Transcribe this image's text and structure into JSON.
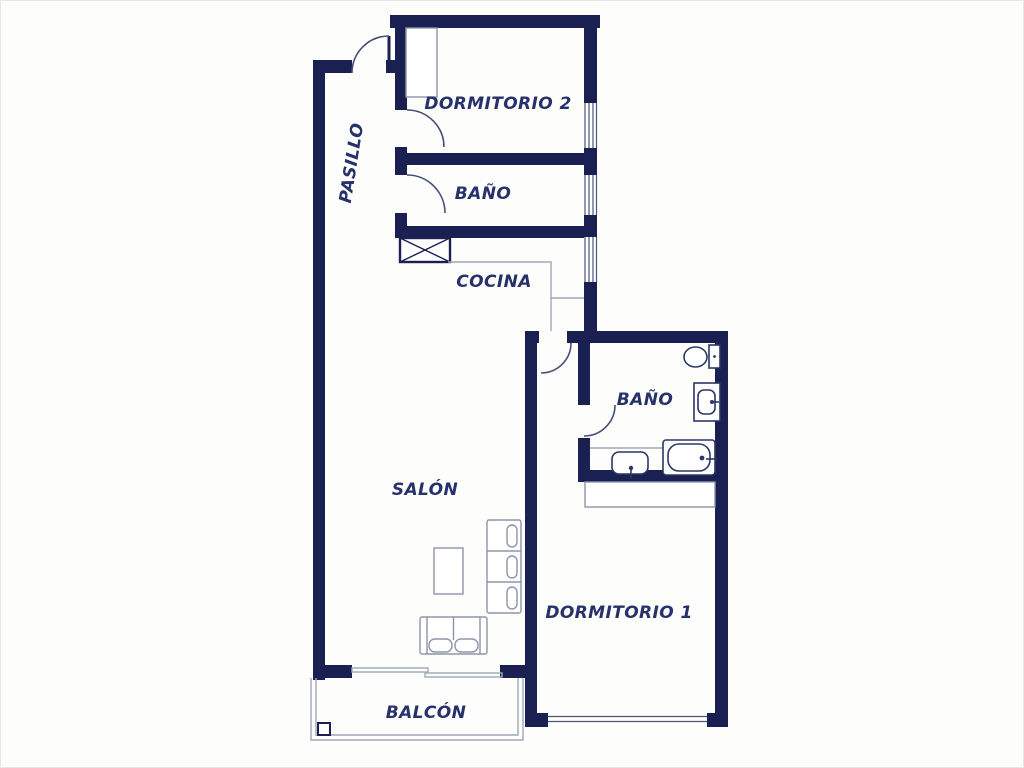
{
  "title": "Apartment floor plan",
  "colors": {
    "wall": "#1a2152",
    "label": "#27316b",
    "thin_line": "#a0a8ba",
    "fixture_line": "#2b3767",
    "background": "#ffffff"
  },
  "rooms": {
    "pasillo": {
      "label": "PASILLO"
    },
    "dormitorio2": {
      "label": "DORMITORIO 2"
    },
    "bano1": {
      "label": "BAÑO"
    },
    "cocina": {
      "label": "COCINA"
    },
    "bano2": {
      "label": "BAÑO"
    },
    "salon": {
      "label": "SALÓN"
    },
    "dormitorio1": {
      "label": "DORMITORIO 1"
    },
    "balcon": {
      "label": "BALCÓN"
    }
  }
}
